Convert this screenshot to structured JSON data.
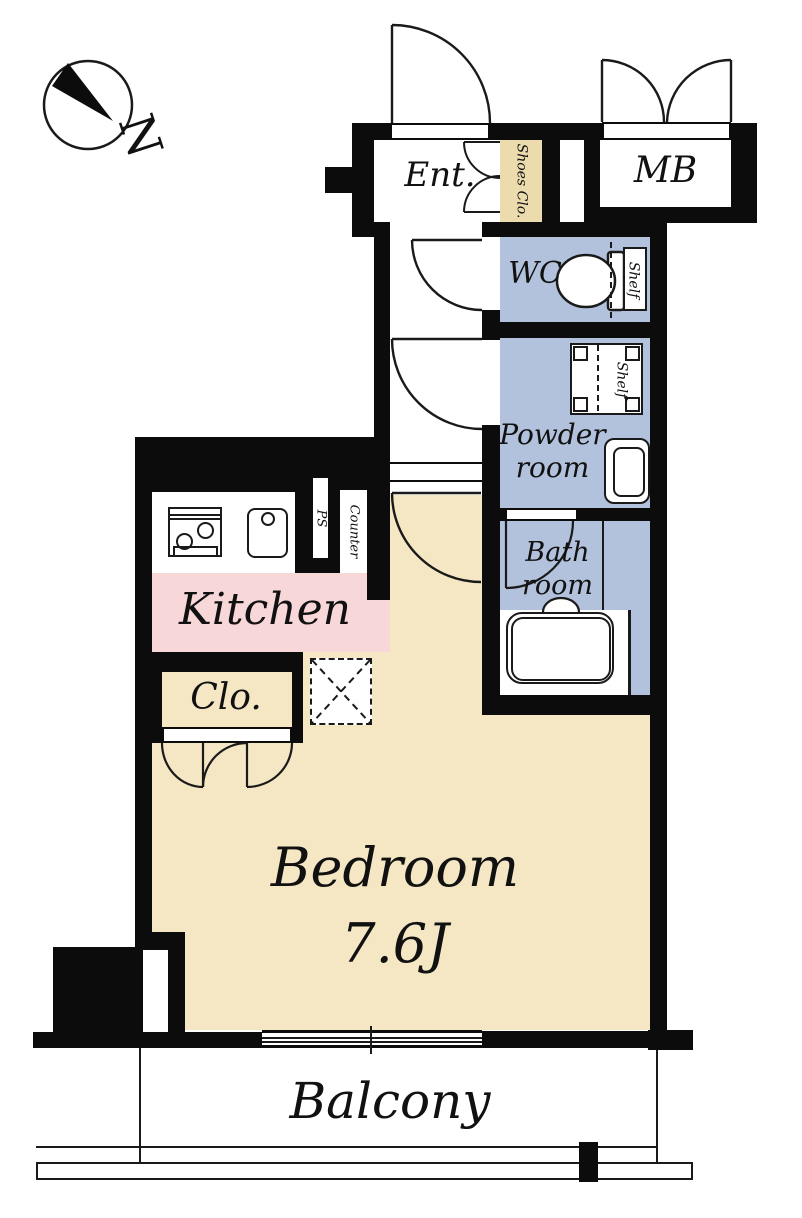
{
  "title": "Studio floor plan",
  "compass": {
    "letter": "N"
  },
  "labels": {
    "ent": "Ent.",
    "shoes_clo": "Shoes Clo.",
    "mb": "MB",
    "wc": "WC",
    "shelf_wc": "Shelf",
    "shelf_powder": "Shelf",
    "powder_1": "Powder",
    "powder_2": "room",
    "bath_1": "Bath",
    "bath_2": "room",
    "kitchen": "Kitchen",
    "ps": "PS",
    "counter": "Counter",
    "clo": "Clo.",
    "bedroom_1": "Bedroom",
    "bedroom_2": "7.6J",
    "balcony": "Balcony"
  },
  "colors": {
    "wall": "#0c0c0c",
    "line": "#1a1a1a",
    "white": "#ffffff",
    "beige": "#f5e7c4",
    "beige-dark": "#ecdbad",
    "pink": "#f8d7d9",
    "blue": "#b2c2dc"
  }
}
